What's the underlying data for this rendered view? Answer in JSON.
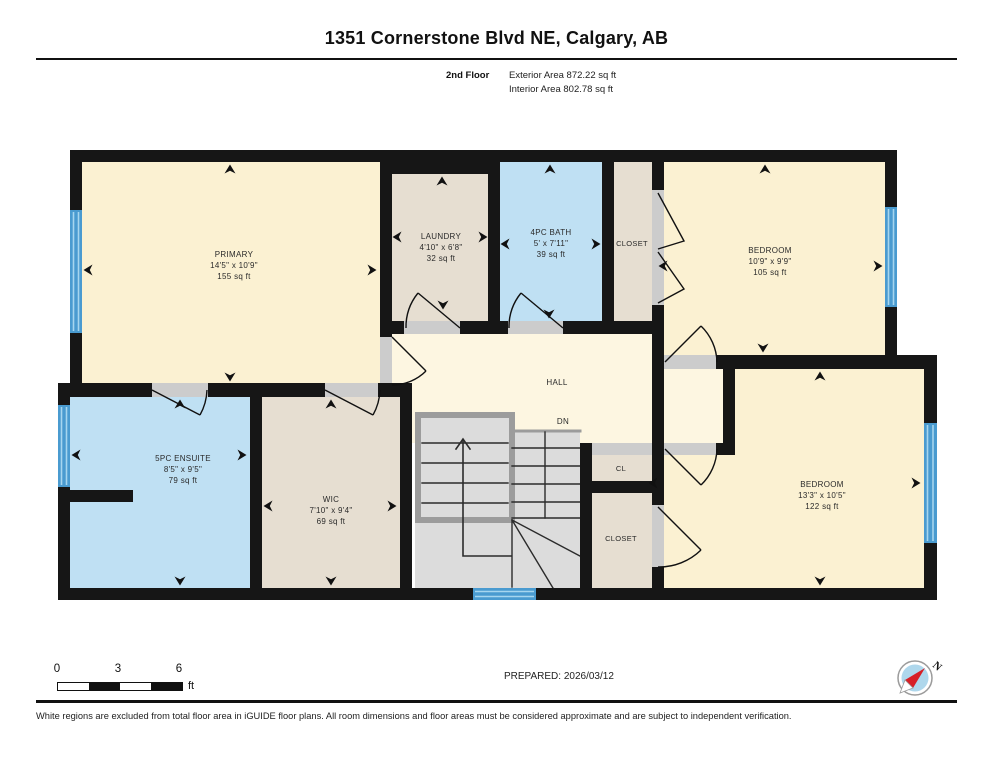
{
  "header": {
    "title": "1351 Cornerstone Blvd NE, Calgary, AB",
    "floor_label": "2nd Floor",
    "exterior_area": "Exterior Area 872.22 sq ft",
    "interior_area": "Interior Area 802.78 sq ft"
  },
  "rooms": {
    "primary": {
      "name": "PRIMARY",
      "dims": "14'5\" x 10'9\"",
      "area": "155 sq ft"
    },
    "laundry": {
      "name": "LAUNDRY",
      "dims": "4'10\" x 6'8\"",
      "area": "32 sq ft"
    },
    "bath": {
      "name": "4PC BATH",
      "dims": "5' x 7'11\"",
      "area": "39 sq ft"
    },
    "closet_top": {
      "name": "CLOSET"
    },
    "bedroom_top": {
      "name": "BEDROOM",
      "dims": "10'9\" x 9'9\"",
      "area": "105 sq ft"
    },
    "hall": {
      "name": "HALL"
    },
    "stairs": {
      "label": "DN"
    },
    "ensuite": {
      "name": "5PC ENSUITE",
      "dims": "8'5\" x 9'5\"",
      "area": "79 sq ft"
    },
    "wic": {
      "name": "WIC",
      "dims": "7'10\" x 9'4\"",
      "area": "69 sq ft"
    },
    "cl": {
      "name": "CL"
    },
    "closet_bottom": {
      "name": "CLOSET"
    },
    "bedroom_bottom": {
      "name": "BEDROOM",
      "dims": "13'3\" x 10'5\"",
      "area": "122 sq ft"
    }
  },
  "scale_bar": {
    "tick0": "0",
    "tick1": "3",
    "tick2": "6",
    "unit": "ft"
  },
  "compass": {
    "label": "N"
  },
  "footer": {
    "prepared": "PREPARED: 2026/03/12",
    "disclaimer": "White regions are excluded from total floor area in iGUIDE floor plans. All room dimensions and floor areas must be considered approximate and are subject to independent verification."
  },
  "palette": {
    "wall": "#161616",
    "room_cream": "#fbf1d2",
    "hall_cream": "#fdf6e1",
    "room_tan": "#e6ded1",
    "room_blue": "#bfe0f3",
    "window_blue": "#4a9bd0",
    "stair_gray": "#dcdcdc",
    "threshold_gray": "#cccccc"
  }
}
